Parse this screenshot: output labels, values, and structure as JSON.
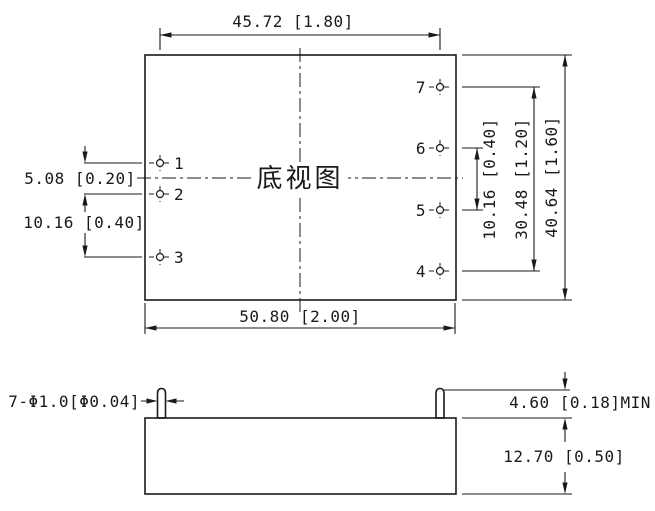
{
  "drawing": {
    "background_color": "#ffffff",
    "line_color": "#1a1a1a",
    "bottom_view": {
      "label": "底视图",
      "dims": {
        "pin_span_width": "45.72 [1.80]",
        "body_width": "50.80 [2.00]",
        "pitch_pin1_pin2": "5.08 [0.20]",
        "pitch_pin2_pin3": "10.16 [0.40]",
        "pitch_pin5_pin6": "10.16 [0.40]",
        "pin_span_height": "30.48 [1.20]",
        "body_height": "40.64 [1.60]"
      },
      "pins": [
        {
          "number": "1"
        },
        {
          "number": "2"
        },
        {
          "number": "3"
        },
        {
          "number": "4"
        },
        {
          "number": "5"
        },
        {
          "number": "6"
        },
        {
          "number": "7"
        }
      ]
    },
    "side_view": {
      "pin_diameter_note": "7-Φ1.0[Φ0.04]",
      "pin_length_min": "4.60 [0.18]MIN",
      "body_thickness": "12.70 [0.50]"
    }
  }
}
